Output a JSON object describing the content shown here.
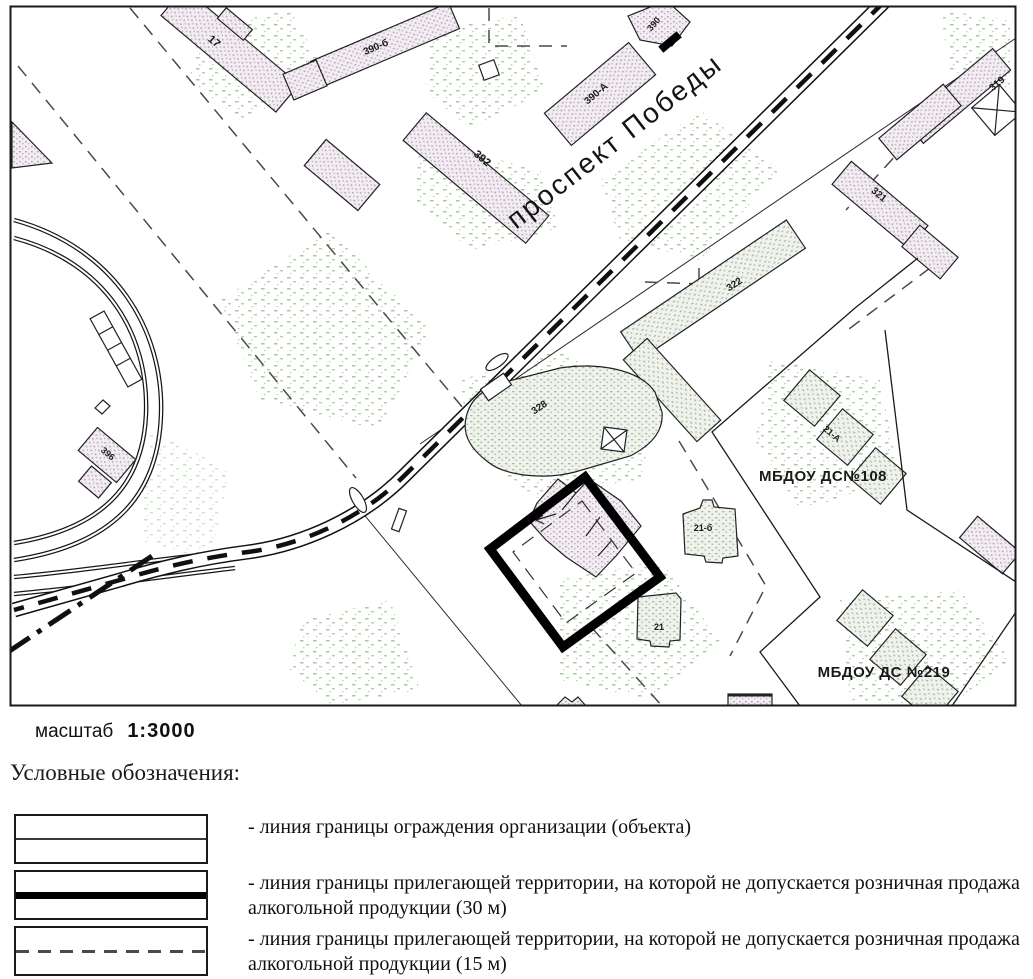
{
  "map": {
    "street_label": "проспект Победы",
    "labels": {
      "b17": "17",
      "b390b": "390-б",
      "b392": "392",
      "b390": "390",
      "b390a": "390-А",
      "b319": "319",
      "b321": "321",
      "b322": "322",
      "b328": "328",
      "b396": "396",
      "b21a": "21-А",
      "b21b": "21-б",
      "b21": "21",
      "kg108": "МБДОУ ДС№108",
      "kg219": "МБДОУ ДС №219"
    }
  },
  "scale": {
    "label": "масштаб",
    "value": "1:3000"
  },
  "legend": {
    "title": "Условные обозначения:",
    "items": [
      {
        "symbol": "thin-solid-line",
        "description": "- линия границы ограждения организации (объекта)"
      },
      {
        "symbol": "thick-solid-line",
        "description": "- линия границы прилегающей территории, на которой не допускается розничная продажа алкогольной продукции (30 м)"
      },
      {
        "symbol": "dashed-line",
        "description": "- линия границы прилегающей территории, на которой не допускается розничная продажа алкогольной продукции (15 м)"
      }
    ]
  },
  "colors": {
    "ink": "#111111",
    "vegetation": "#a3cc9b",
    "building_speckle": "#b49fb4",
    "dash_gray": "#555555"
  }
}
